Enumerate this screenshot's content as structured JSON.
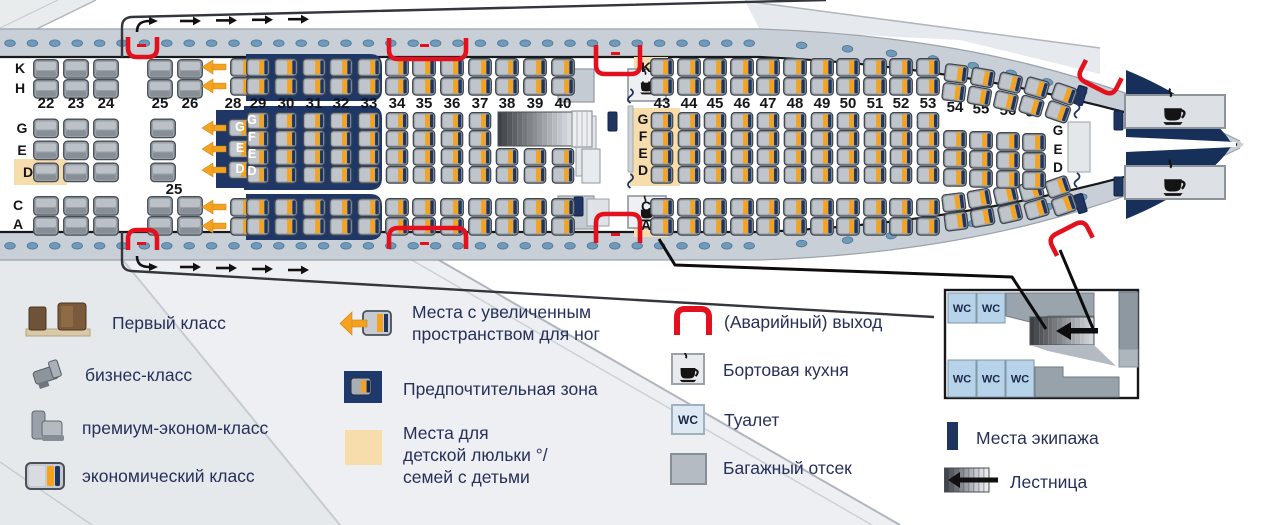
{
  "labels": {
    "wc": "WC"
  },
  "legend": {
    "classes": [
      {
        "label": "Первый класс"
      },
      {
        "label": "бизнес-класс"
      },
      {
        "label": "премиум-эконом-класс"
      },
      {
        "label": "экономический класс"
      }
    ],
    "features": [
      {
        "label": "Места с увеличенным\nпространством для ног"
      },
      {
        "label": "Предпочтительная зона"
      },
      {
        "label": "Места для\nдетской люльки °/\nсемей с детьми"
      }
    ],
    "facilities": [
      {
        "label": "(Аварийный) выход"
      },
      {
        "label": "Бортовая кухня"
      },
      {
        "label": "Туалет"
      },
      {
        "label": "Багажный отсек"
      }
    ],
    "crew": {
      "label": "Места экипажа"
    },
    "stairs": {
      "label": "Лестница"
    }
  },
  "seatmap": {
    "premium": {
      "rows": [
        "22",
        "23",
        "24",
        "25",
        "26"
      ],
      "mid_extra_label": "25",
      "letters_top": [
        "K",
        "H"
      ],
      "letters_mid": [
        "G",
        "E",
        "D"
      ],
      "letters_bottom": [
        "C",
        "A"
      ]
    },
    "economy_front": {
      "rows": [
        "28",
        "29",
        "30",
        "31",
        "32",
        "33",
        "34",
        "35",
        "36",
        "37",
        "38",
        "39",
        "40"
      ],
      "letters_mid_row28": [
        "G",
        "E",
        "D"
      ],
      "letters_mid_row29": [
        "G",
        "F",
        "E",
        "D"
      ]
    },
    "economy_rear": {
      "rows": [
        "43",
        "44",
        "45",
        "46",
        "47",
        "48",
        "49",
        "50",
        "51",
        "52",
        "53",
        "54",
        "55",
        "56",
        "57",
        "58"
      ],
      "letters_top": [
        "K",
        "H"
      ],
      "letters_mid": [
        "G",
        "F",
        "E",
        "D"
      ],
      "letters_bottom": [
        "C",
        "A"
      ],
      "letters_tail": [
        "G",
        "E",
        "D"
      ]
    }
  },
  "colors": {
    "preferred_navy": "#1e3766",
    "seat_orange": "#f5a31f",
    "seat_navy_stripe": "#1e3560",
    "exit_red": "#e3101e",
    "bassinet_tan": "#f7ddab",
    "hull_gray": "#c9cfd6",
    "window_blue": "#6f9aba",
    "legend_text": "#273059"
  }
}
